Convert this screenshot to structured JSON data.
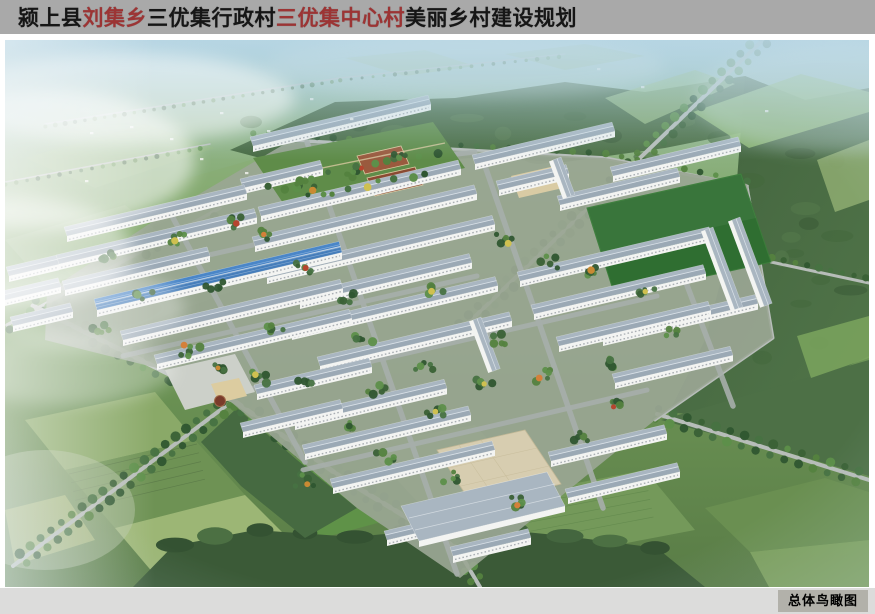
{
  "title": {
    "segments": [
      {
        "text": "颍上县",
        "color": "dark"
      },
      {
        "text": "刘集乡",
        "color": "red"
      },
      {
        "text": "三优集行政村",
        "color": "dark"
      },
      {
        "text": "三优集中心村",
        "color": "red"
      },
      {
        "text": "美丽乡村建设规划",
        "color": "dark"
      }
    ]
  },
  "caption": {
    "label": "总体鸟瞰图"
  },
  "palette": {
    "title_bar_bg": "#a9a9a9",
    "title_text": "#161616",
    "title_accent": "#9c3434",
    "caption_bar_bg": "#dcdcdb",
    "caption_badge_bg": "#b2b1aa",
    "caption_text": "#000000",
    "sky_haze": "#aed3e2",
    "field_green": "#7ca35f",
    "forest_green": "#4a6c44",
    "road_gray": "#b7bdb9",
    "roof_gray": "#a9b6c1",
    "roof_blue": "#4a86c8",
    "building_wall": "#f3f4f2",
    "plaza_tan": "#d7cdb0",
    "sports_green": "#2f6e31",
    "tree_green": "#3f6e35"
  },
  "scene": {
    "description": "Aerial bird's-eye rendering of the village plan: rows of white buildings with gray tiled roofs, one long blue-roofed building, central garden with brown plots, sports field, tan plaza, village square with round fountain, tree-lined roads, surrounded by farmland strips and forest."
  }
}
